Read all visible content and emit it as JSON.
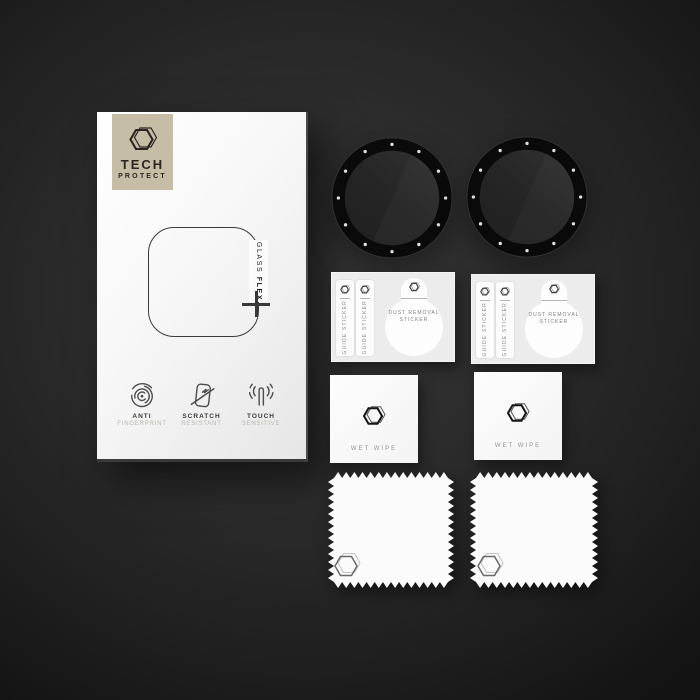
{
  "brand": {
    "line1": "TECH",
    "line2": "PROTECT",
    "logo_icon": "hexagon-3d",
    "badge_color": "#c6bda6",
    "text_color": "#2b2520"
  },
  "box": {
    "glass_word": "GLASS",
    "flex_word": "FLEX",
    "plus_symbol": "+",
    "features": [
      {
        "icon": "fingerprint-icon",
        "title": "ANTI",
        "subtitle": "FINGERPRINT"
      },
      {
        "icon": "scratch-resistant-icon",
        "title": "SCRATCH",
        "subtitle": "RESISTANT"
      },
      {
        "icon": "touch-sensitive-icon",
        "title": "TOUCH",
        "subtitle": "SENSITIVE"
      }
    ]
  },
  "accessories": {
    "guide_sticker_label": "GUIDE STICKER",
    "dust_removal_line1": "DUST REMOVAL",
    "dust_removal_line2": "STICKER",
    "wet_wipe_label": "WET WIPE",
    "quantities_visible": {
      "watch_protectors": 2,
      "sticker_sheets": 2,
      "wet_wipes": 2,
      "microfiber_cloths": 2
    }
  },
  "colors": {
    "background_dark": "#1c1c1c",
    "box_face": "#ffffff",
    "accent_beige": "#c6bda6",
    "bezel_black": "#0a0a0a",
    "bezel_dots": "#e0e0e0",
    "glass_tint": "#272727"
  }
}
